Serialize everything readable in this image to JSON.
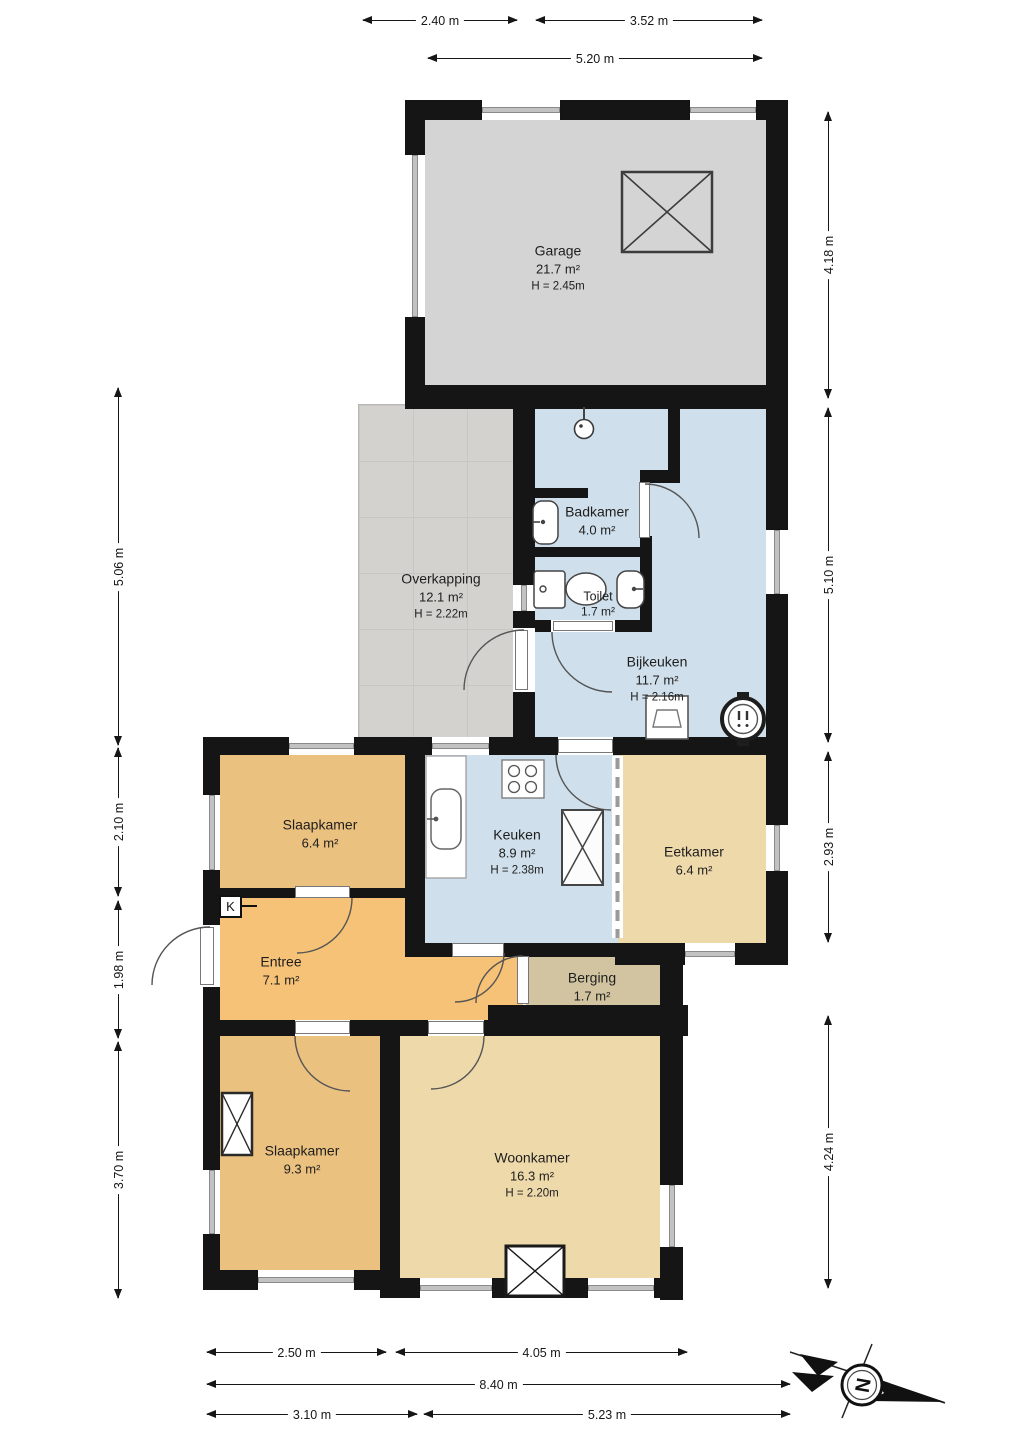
{
  "rooms": [
    {
      "id": "garage",
      "name": "Garage",
      "area": "21.7 m²",
      "height": "H = 2.45m"
    },
    {
      "id": "overkapping",
      "name": "Overkapping",
      "area": "12.1 m²",
      "height": "H = 2.22m"
    },
    {
      "id": "badkamer",
      "name": "Badkamer",
      "area": "4.0 m²"
    },
    {
      "id": "toilet",
      "name": "Toilet",
      "area": "1.7 m²"
    },
    {
      "id": "bijkeuken",
      "name": "Bijkeuken",
      "area": "11.7 m²",
      "height": "H = 2.16m"
    },
    {
      "id": "slaapkamer-boven",
      "name": "Slaapkamer",
      "area": "6.4 m²"
    },
    {
      "id": "keuken",
      "name": "Keuken",
      "area": "8.9 m²",
      "height": "H = 2.38m"
    },
    {
      "id": "eetkamer",
      "name": "Eetkamer",
      "area": "6.4 m²"
    },
    {
      "id": "entree",
      "name": "Entree",
      "area": "7.1 m²"
    },
    {
      "id": "berging",
      "name": "Berging",
      "area": "1.7 m²"
    },
    {
      "id": "slaapkamer",
      "name": "Slaapkamer",
      "area": "9.3 m²"
    },
    {
      "id": "woonkamer",
      "name": "Woonkamer",
      "area": "16.3 m²",
      "height": "H = 2.20m"
    }
  ],
  "dimensions": {
    "top": [
      {
        "label": "2.40 m"
      },
      {
        "label": "3.52 m"
      },
      {
        "label": "5.20 m"
      }
    ],
    "right": [
      {
        "label": "4.18 m"
      },
      {
        "label": "5.10 m"
      },
      {
        "label": "2.93 m"
      },
      {
        "label": "4.24 m"
      }
    ],
    "left": [
      {
        "label": "5.06 m"
      },
      {
        "label": "2.10 m"
      },
      {
        "label": "1.98 m"
      },
      {
        "label": "3.70 m"
      }
    ],
    "bottom": [
      {
        "label": "2.50 m"
      },
      {
        "label": "4.05 m"
      },
      {
        "label": "8.40 m"
      },
      {
        "label": "3.10 m"
      },
      {
        "label": "5.23 m"
      }
    ]
  },
  "meter_cupboard_label": "K",
  "compass": {
    "north_label": "N"
  },
  "colors": {
    "wall": "#151515",
    "garage": "#d4d4d4",
    "overkapping": "#d3d2cf",
    "wet": "#cfdfeb",
    "bedroom": "#ebc180",
    "living": "#eed9ab",
    "entree": "#f5c277",
    "berging": "#d2c4a0"
  }
}
